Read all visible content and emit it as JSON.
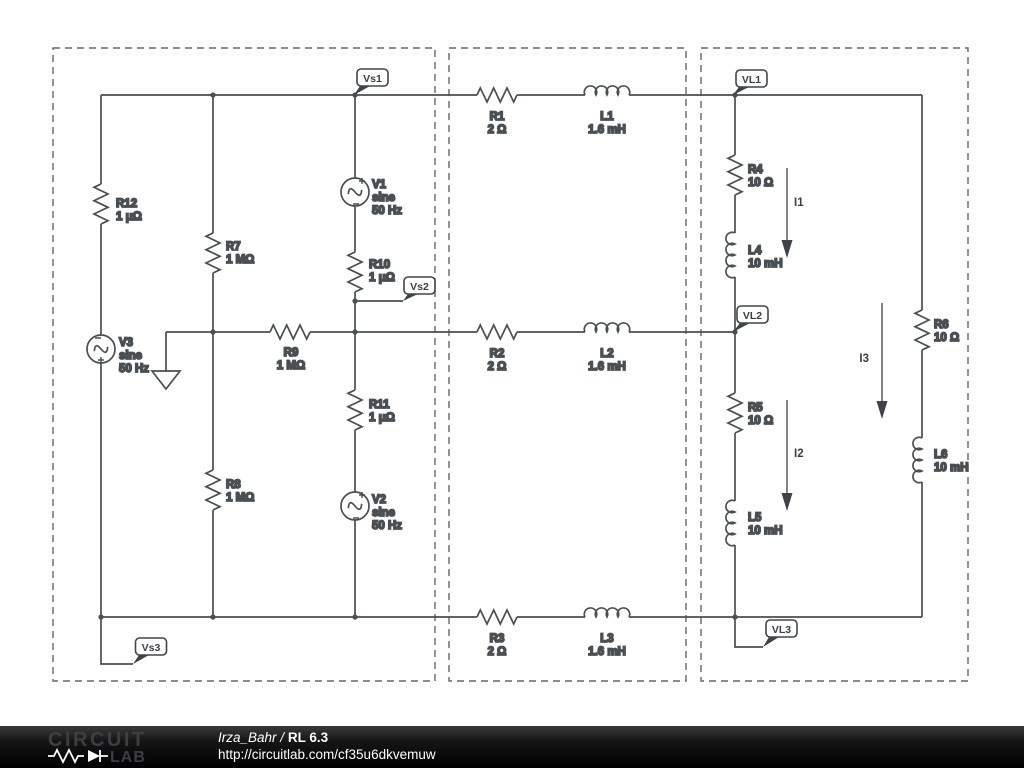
{
  "footer": {
    "logo": {
      "word1": "CIRCUIT",
      "word2": "LAB"
    },
    "author": "Irza_Bahr",
    "divider": "/",
    "title": "RL 6.3",
    "url": "http://circuitlab.com/cf35u6dkvemuw"
  },
  "flags": {
    "vs1": "Vs1",
    "vs2": "Vs2",
    "vs3": "Vs3",
    "vl1": "VL1",
    "vl2": "VL2",
    "vl3": "VL3"
  },
  "currents": {
    "i1": "I1",
    "i2": "I2",
    "i3": "I3"
  },
  "components": {
    "r1": {
      "name": "R1",
      "value": "2 Ω"
    },
    "r2": {
      "name": "R2",
      "value": "2 Ω"
    },
    "r3": {
      "name": "R3",
      "value": "2 Ω"
    },
    "r4": {
      "name": "R4",
      "value": "10 Ω"
    },
    "r5": {
      "name": "R5",
      "value": "10 Ω"
    },
    "r6": {
      "name": "R6",
      "value": "10 Ω"
    },
    "r7": {
      "name": "R7",
      "value": "1 MΩ"
    },
    "r8": {
      "name": "R8",
      "value": "1 MΩ"
    },
    "r9": {
      "name": "R9",
      "value": "1 MΩ"
    },
    "r10": {
      "name": "R10",
      "value": "1 μΩ"
    },
    "r11": {
      "name": "R11",
      "value": "1 μΩ"
    },
    "r12": {
      "name": "R12",
      "value": "1 μΩ"
    },
    "l1": {
      "name": "L1",
      "value": "1.6 mH"
    },
    "l2": {
      "name": "L2",
      "value": "1.6 mH"
    },
    "l3": {
      "name": "L3",
      "value": "1.6 mH"
    },
    "l4": {
      "name": "L4",
      "value": "10 mH"
    },
    "l5": {
      "name": "L5",
      "value": "10 mH"
    },
    "l6": {
      "name": "L6",
      "value": "10 mH"
    },
    "v1": {
      "name": "V1",
      "value": "sine",
      "freq": "50 Hz"
    },
    "v2": {
      "name": "V2",
      "value": "sine",
      "freq": "50 Hz"
    },
    "v3": {
      "name": "V3",
      "value": "sine",
      "freq": "50 Hz"
    }
  },
  "colors": {
    "wire": "#4a4f54",
    "label_text": "#3b3f44",
    "dashed_box": "#62676d",
    "footer_bg": "#0d0d0d",
    "footer_text": "#ffffff"
  }
}
